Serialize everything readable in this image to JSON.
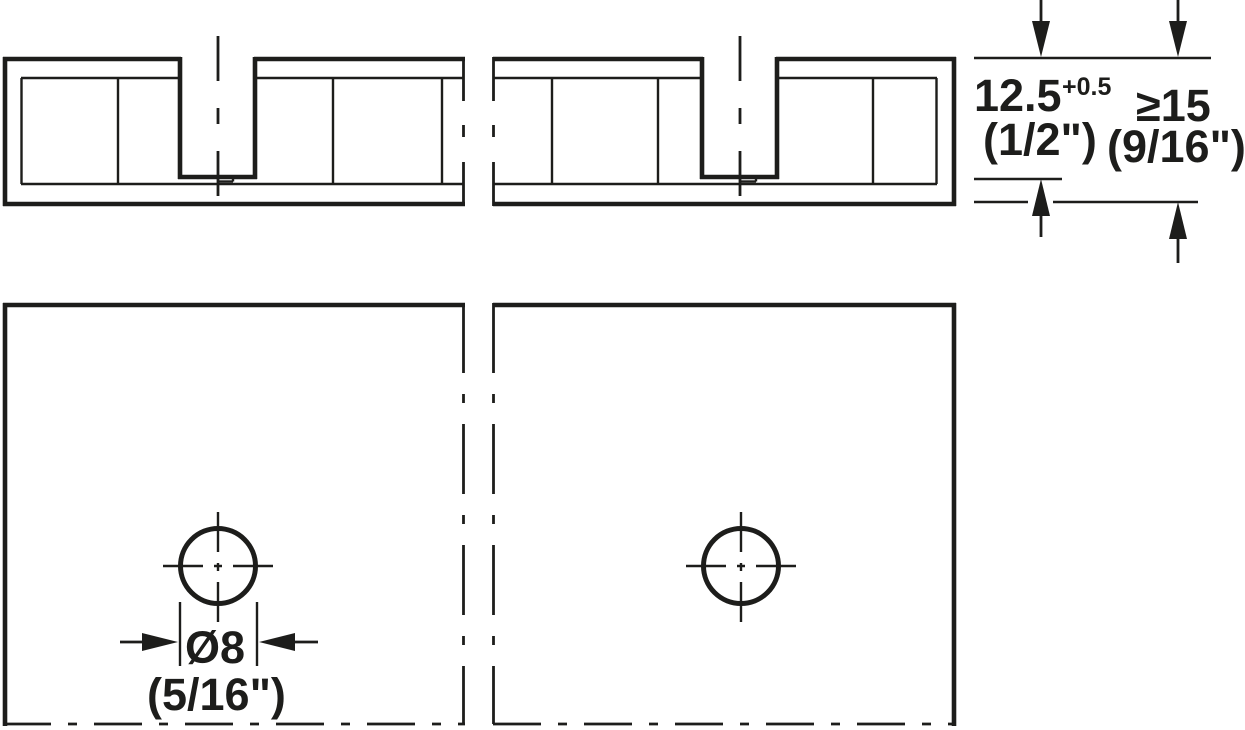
{
  "dimensions": {
    "drilling_depth": {
      "metric": "12.5",
      "tolerance": "+0.5",
      "imperial": "(1/2\")"
    },
    "min_thickness": {
      "metric": "≥15",
      "imperial": "(9/16\")"
    },
    "hole_diameter": {
      "metric": "Ø8",
      "imperial": "(5/16\")"
    }
  },
  "colors": {
    "line": "#1d1d1b",
    "background": "#ffffff"
  }
}
